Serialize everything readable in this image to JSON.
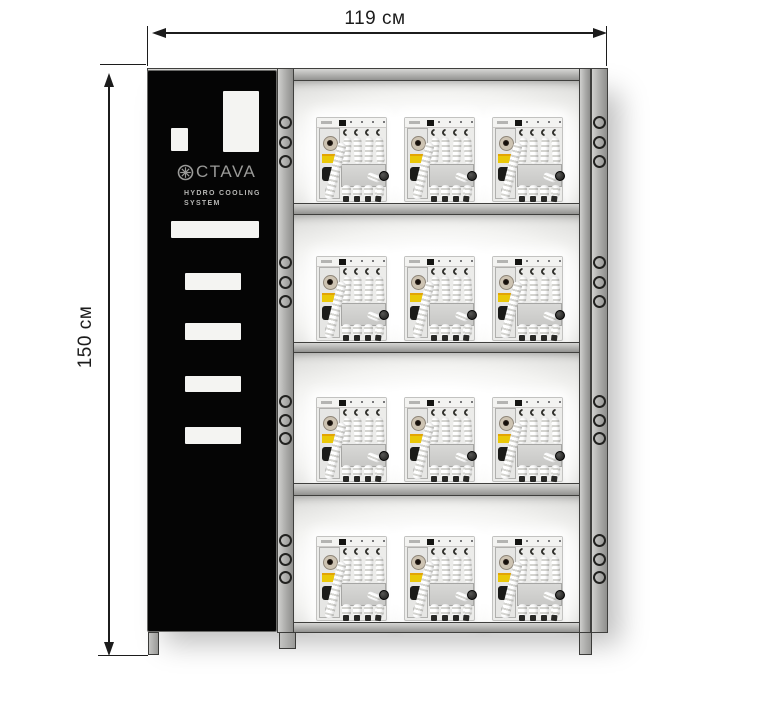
{
  "diagram": {
    "width_label": "119 см",
    "height_label": "150 см"
  },
  "cabinet": {
    "brand": "OCTAVA",
    "logo_icon": "fan-logo-icon",
    "logo_text": "CTAVA",
    "subtitle_line1": "HYDRO COOLING",
    "subtitle_line2": "SYSTEM",
    "vent_count": 7
  },
  "rack": {
    "rows": 4,
    "units_per_row": 3,
    "holes_per_side_per_row": 3,
    "legs": 3
  },
  "colors": {
    "dimension_line": "#1c1c1c",
    "cabinet": "#050505",
    "logo_gray": "#9a9a98",
    "rack_gray": "#b3b3b1",
    "accent_yellow": "#eac808"
  }
}
